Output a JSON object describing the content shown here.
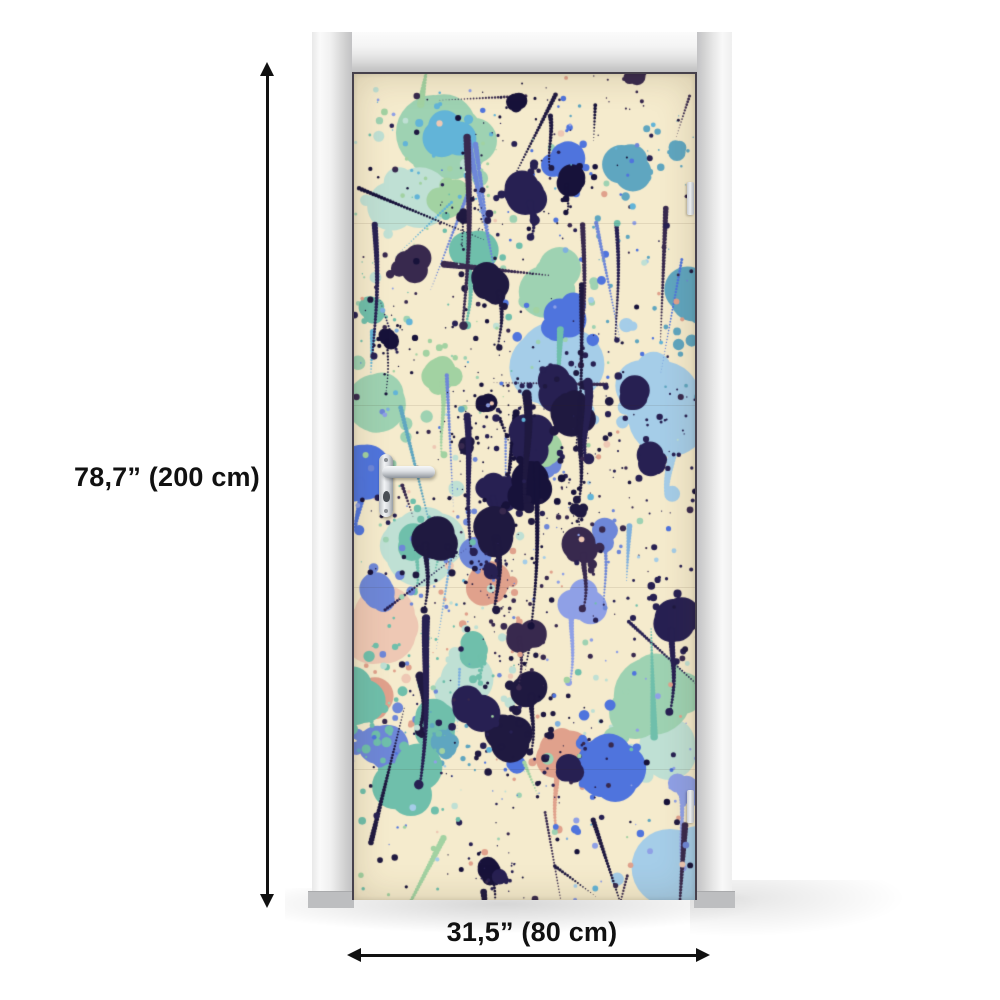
{
  "annotations": {
    "height_label": "78,7” (200 cm)",
    "width_label": "31,5” (80 cm)",
    "arrow_color": "#111111"
  },
  "frame": {
    "color_light": "#fafafa",
    "color_mid": "#e6e6e6",
    "color_dark": "#c2c2c4"
  },
  "mural": {
    "style": "abstract paint splatter door mural",
    "background": "#f5ebcd",
    "seed": 12,
    "palette": {
      "pastel": [
        "#e0a18c",
        "#eec8b4",
        "#a5cde8",
        "#bfe0d4",
        "#9ed2b2"
      ],
      "mid": [
        "#6e87d8",
        "#8fa0e6",
        "#7fb0de",
        "#5fa6c0",
        "#6fbfab",
        "#a2d2a2",
        "#4f74dd",
        "#62b4d8"
      ],
      "dark": [
        "#1f1940",
        "#17123a",
        "#38294e",
        "#272052"
      ]
    },
    "counts": {
      "pastel_splats": 15,
      "mid_splats": 27,
      "dark_splats": 30,
      "streaks": 42,
      "drips": 12,
      "dots": 330
    },
    "seams_y": [
      149,
      331,
      513,
      695
    ]
  }
}
